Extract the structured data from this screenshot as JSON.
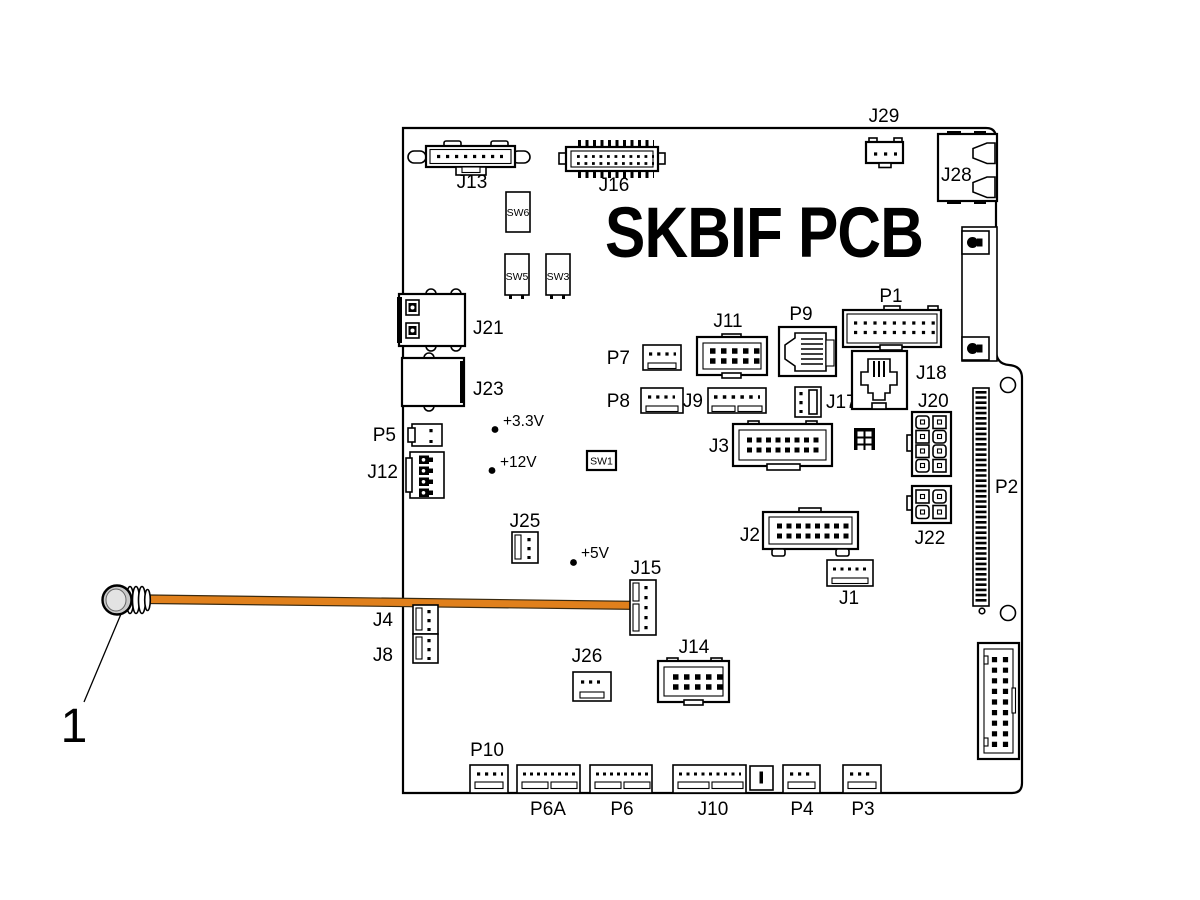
{
  "title": "SKBIF PCB",
  "callout": {
    "number": "1"
  },
  "labels": {
    "j13": "J13",
    "j16": "J16",
    "j29": "J29",
    "j28": "J28",
    "sw6": "SW6",
    "sw5": "SW5",
    "sw3": "SW3",
    "sw1": "SW1",
    "j21": "J21",
    "j23": "J23",
    "p5": "P5",
    "j12": "J12",
    "p7": "P7",
    "j11": "J11",
    "p9": "P9",
    "p1": "P1",
    "p8": "P8",
    "j9": "J9",
    "j17": "J17",
    "j18": "J18",
    "j20": "J20",
    "j3": "J3",
    "j2": "J2",
    "j22": "J22",
    "p2": "P2",
    "j25": "J25",
    "j15": "J15",
    "j1": "J1",
    "j4": "J4",
    "j8": "J8",
    "j26": "J26",
    "j14": "J14",
    "p10": "P10",
    "p6a": "P6A",
    "p6": "P6",
    "j10": "J10",
    "p4": "P4",
    "p3": "P3"
  },
  "test_points": {
    "tp33": "+3.3V",
    "tp12": "+12V",
    "tp5": "+5V"
  },
  "colors": {
    "cable": "#E0801C",
    "line": "#000000",
    "background": "#FFFFFF"
  }
}
